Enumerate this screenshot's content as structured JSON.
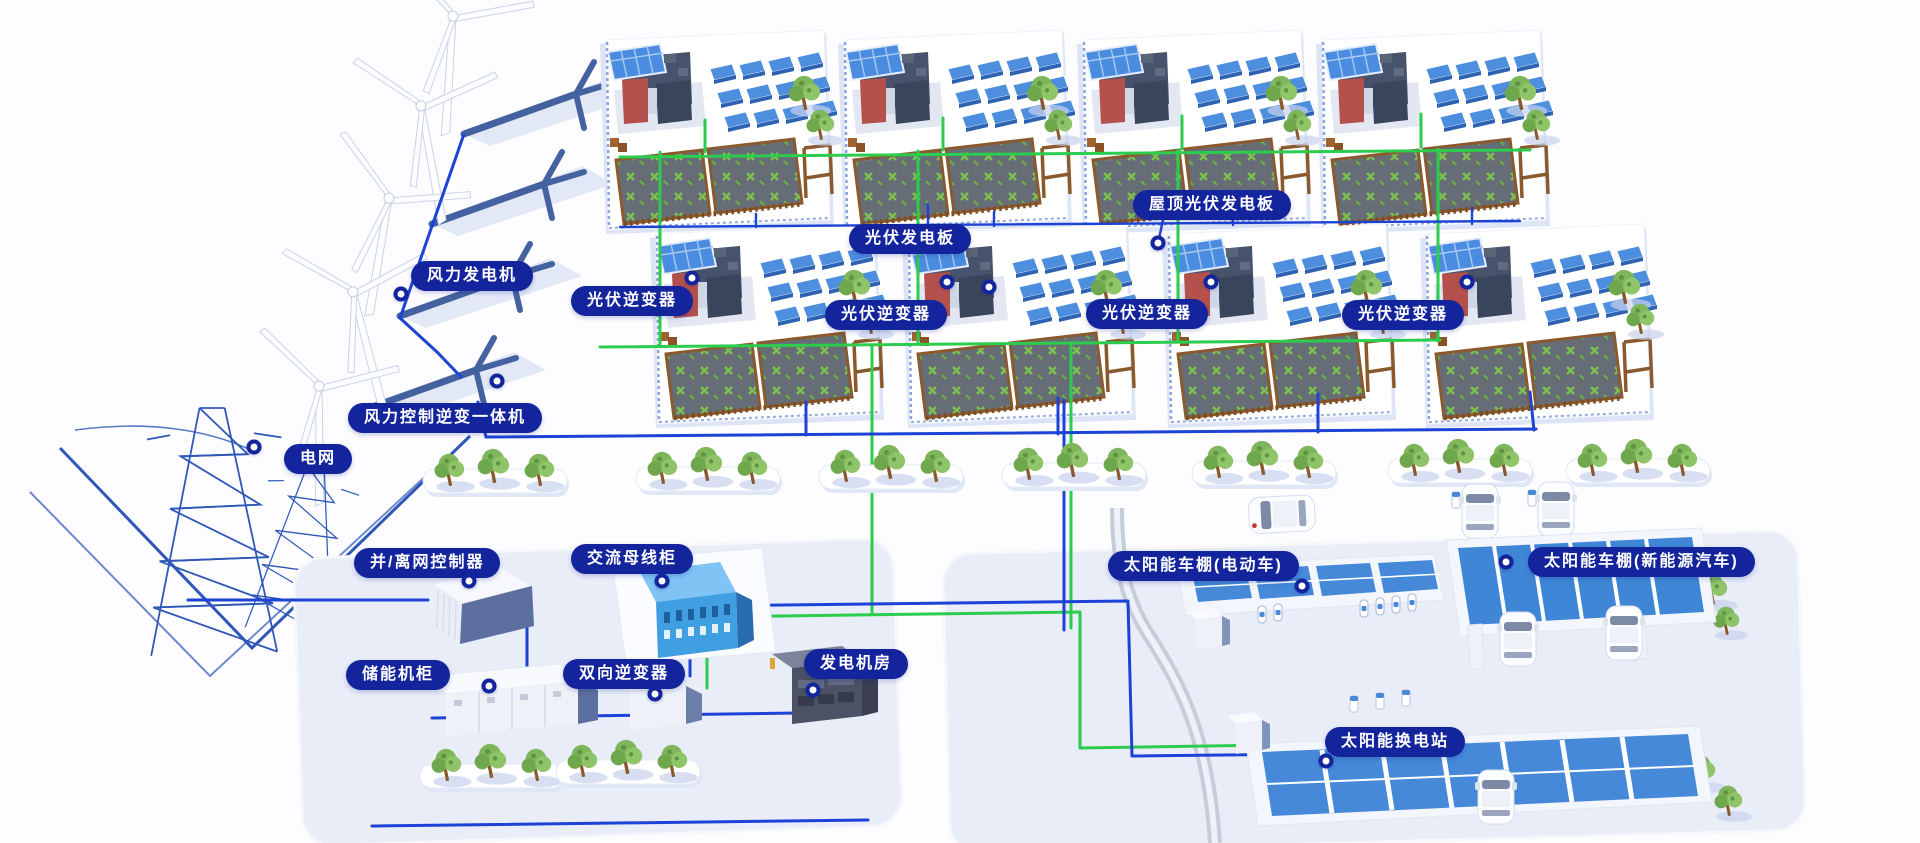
{
  "colors": {
    "label_bg": "#13249c",
    "line_blue": "#1c43d6",
    "line_green": "#2ccc4e",
    "panel_blue": "#4a8de0",
    "panel_dark": "#2e62b2",
    "platform": "#e9edf8",
    "tree_green": "#7fb65b"
  },
  "callouts": [
    {
      "id": "wind-turbine",
      "label": "风力发电机",
      "x": 411,
      "y": 261,
      "dot": {
        "x": 401,
        "y": 294
      }
    },
    {
      "id": "wind-inverter-unit",
      "label": "风力控制逆变一体机",
      "x": 348,
      "y": 403,
      "dot": {
        "x": 497,
        "y": 381
      }
    },
    {
      "id": "power-grid",
      "label": "电网",
      "x": 284,
      "y": 444,
      "dot": {
        "x": 254,
        "y": 447
      }
    },
    {
      "id": "grid-controller",
      "label": "并/离网控制器",
      "x": 354,
      "y": 548,
      "dot": {
        "x": 469,
        "y": 581
      }
    },
    {
      "id": "ac-busbar-cabinet",
      "label": "交流母线柜",
      "x": 571,
      "y": 544,
      "dot": {
        "x": 662,
        "y": 581
      }
    },
    {
      "id": "storage-cabinet",
      "label": "储能机柜",
      "x": 346,
      "y": 660,
      "dot": {
        "x": 489,
        "y": 686
      }
    },
    {
      "id": "bidirectional-inverter",
      "label": "双向逆变器",
      "x": 563,
      "y": 659,
      "dot": {
        "x": 655,
        "y": 694
      }
    },
    {
      "id": "generator-room",
      "label": "发电机房",
      "x": 804,
      "y": 649,
      "dot": {
        "x": 813,
        "y": 690
      }
    },
    {
      "id": "pv-panel",
      "label": "光伏发电板",
      "x": 849,
      "y": 224,
      "dot": {
        "x": 989,
        "y": 287
      }
    },
    {
      "id": "rooftop-pv-panel",
      "label": "屋顶光伏发电板",
      "x": 1133,
      "y": 190,
      "dot": {
        "x": 1158,
        "y": 243
      }
    },
    {
      "id": "pv-inverter-1",
      "label": "光伏逆变器",
      "x": 571,
      "y": 286,
      "dot": {
        "x": 692,
        "y": 278
      }
    },
    {
      "id": "pv-inverter-2",
      "label": "光伏逆变器",
      "x": 825,
      "y": 300,
      "dot": {
        "x": 947,
        "y": 282
      }
    },
    {
      "id": "pv-inverter-3",
      "label": "光伏逆变器",
      "x": 1086,
      "y": 299,
      "dot": {
        "x": 1211,
        "y": 282
      }
    },
    {
      "id": "pv-inverter-4",
      "label": "光伏逆变器",
      "x": 1342,
      "y": 300,
      "dot": {
        "x": 1467,
        "y": 282
      }
    },
    {
      "id": "solar-carport-ev",
      "label": "太阳能车棚(电动车)",
      "x": 1108,
      "y": 551,
      "dot": {
        "x": 1302,
        "y": 586
      }
    },
    {
      "id": "solar-carport-nev",
      "label": "太阳能车棚(新能源汽车)",
      "x": 1528,
      "y": 547,
      "dot": {
        "x": 1506,
        "y": 562
      }
    },
    {
      "id": "solar-swap-station",
      "label": "太阳能换电站",
      "x": 1325,
      "y": 727,
      "dot": {
        "x": 1326,
        "y": 761
      }
    }
  ]
}
